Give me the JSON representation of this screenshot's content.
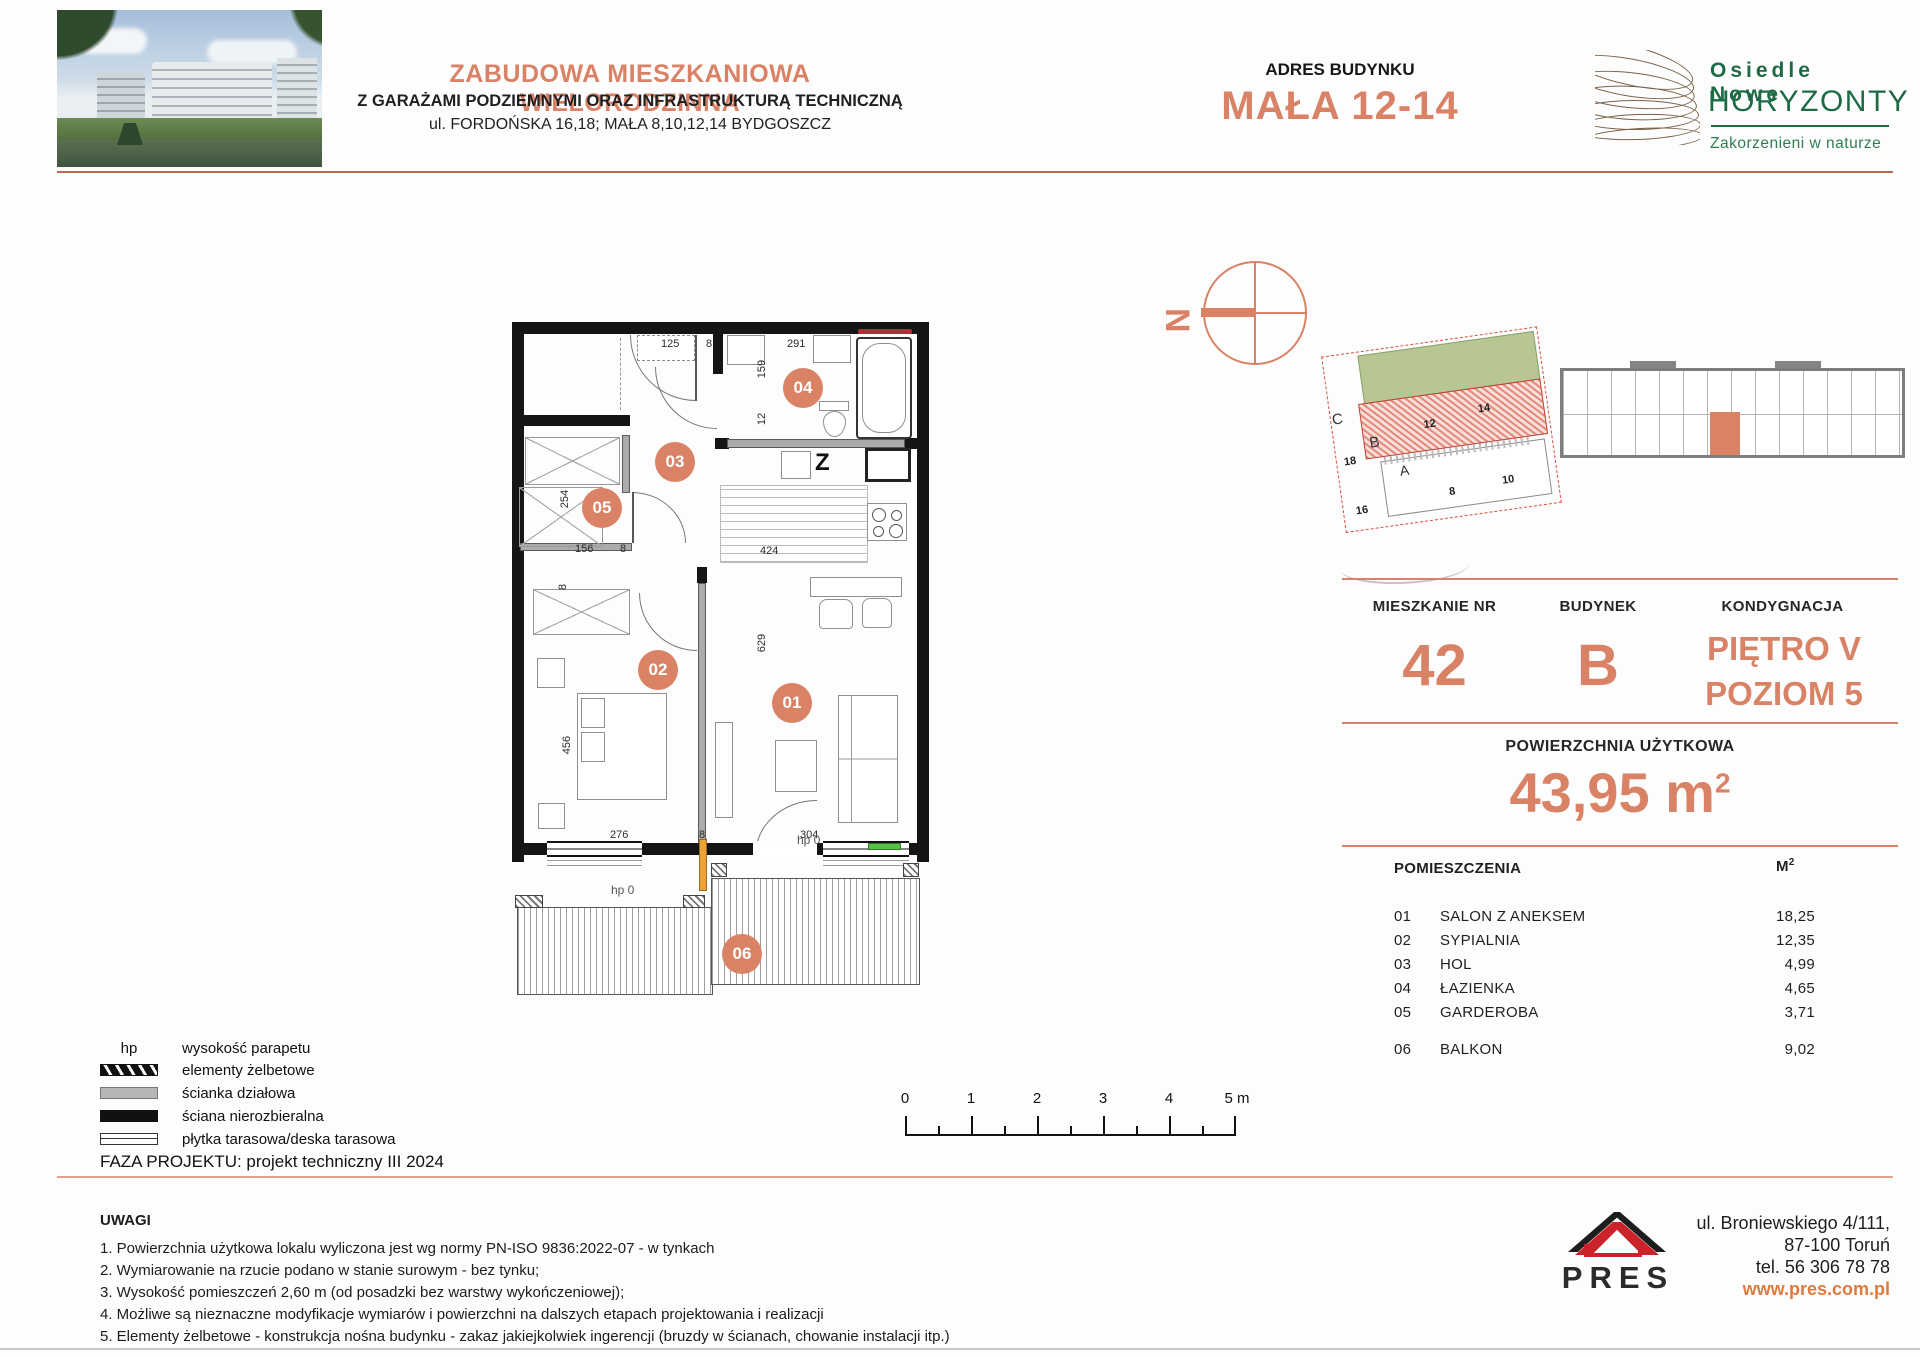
{
  "colors": {
    "accent": "#D98266",
    "green": "#1D6B44",
    "red": "#CC2229",
    "link": "#DF7A3E"
  },
  "header": {
    "title": "ZABUDOWA MIESZKANIOWA WIELORODZINNA",
    "subtitle": "Z GARAŻAMI PODZIEMNYMI ORAZ INFRASTRUKTURĄ TECHNICZNĄ",
    "address_line": "ul. FORDOŃSKA 16,18; MAŁA 8,10,12,14 BYDGOSZCZ",
    "building_address_label": "ADRES BUDYNKU",
    "building_address": "MAŁA 12-14",
    "logo": {
      "line1": "Osiedle Nowe",
      "line2": "HORYZONTY",
      "tagline": "Zakorzenieni w naturze"
    }
  },
  "compass": {
    "north_label": "N"
  },
  "site_plan": {
    "labels": {
      "c": "C",
      "n18": "18",
      "n16": "16",
      "b": "B",
      "n12": "12",
      "n14": "14",
      "a": "A",
      "n8": "8",
      "n10": "10"
    }
  },
  "info_panel": {
    "apartment_label": "MIESZKANIE NR",
    "apartment_number": "42",
    "building_label": "BUDYNEK",
    "building": "B",
    "floor_label": "KONDYGNACJA",
    "floor_line1": "PIĘTRO V",
    "floor_line2": "POZIOM 5",
    "area_label": "POWIERZCHNIA UŻYTKOWA",
    "area_value": "43,95 m",
    "area_sup": "2",
    "rooms_header": "POMIESZCZENIA",
    "rooms_unit": "M",
    "rooms_unit_sup": "2",
    "rooms": [
      {
        "no": "01",
        "name": "SALON Z ANEKSEM",
        "area": "18,25"
      },
      {
        "no": "02",
        "name": "SYPIALNIA",
        "area": "12,35"
      },
      {
        "no": "03",
        "name": "HOL",
        "area": "4,99"
      },
      {
        "no": "04",
        "name": "ŁAZIENKA",
        "area": "4,65"
      },
      {
        "no": "05",
        "name": "GARDEROBA",
        "area": "3,71"
      },
      {
        "no": "06",
        "name": "BALKON",
        "area": "9,02"
      }
    ]
  },
  "floor_plan": {
    "rooms": [
      "01",
      "02",
      "03",
      "04",
      "05",
      "06"
    ],
    "dims": {
      "d125": "125",
      "d8a": "8",
      "d291": "291",
      "d159": "159",
      "d12": "12",
      "d254": "254",
      "d156": "156",
      "d8b": "8",
      "d424": "424",
      "d8c": "8",
      "d456": "456",
      "d276": "276",
      "d8d": "8",
      "d304": "304",
      "d629": "629",
      "hp_left": "hp 0",
      "hp_right": "hp 0",
      "kitchen_z": "Z"
    }
  },
  "scale_bar": {
    "ticks": [
      "0",
      "1",
      "2",
      "3",
      "4",
      "5 m"
    ]
  },
  "legend": {
    "hp_symbol": "hp",
    "items": [
      {
        "label": "wysokość parapetu"
      },
      {
        "label": "elementy żelbetowe"
      },
      {
        "label": "ścianka działowa"
      },
      {
        "label": "ściana nierozbieralna"
      },
      {
        "label": "płytka tarasowa/deska tarasowa"
      }
    ]
  },
  "project_phase": "FAZA PROJEKTU: projekt techniczny III 2024",
  "notes": {
    "title": "UWAGI",
    "items": [
      "1. Powierzchnia użytkowa lokalu wyliczona jest wg normy PN-ISO 9836:2022-07 - w tynkach",
      "2. Wymiarowanie na rzucie podano w stanie surowym - bez tynku;",
      "3. Wysokość pomieszczeń 2,60 m (od posadzki bez warstwy wykończeniowej);",
      "4. Możliwe są nieznaczne modyfikacje wymiarów i powierzchni na dalszych etapach projektowania i realizacji",
      "5. Elementy żelbetowe - konstrukcja nośna budynku - zakaz jakiejkolwiek ingerencji (bruzdy w ścianach, chowanie instalacji itp.)"
    ]
  },
  "footer": {
    "company": "PRES",
    "address_line1": "ul. Broniewskiego  4/111,",
    "address_line2": "87-100 Toruń",
    "address_line3": "tel. 56 306 78 78",
    "website": "www.pres.com.pl"
  }
}
